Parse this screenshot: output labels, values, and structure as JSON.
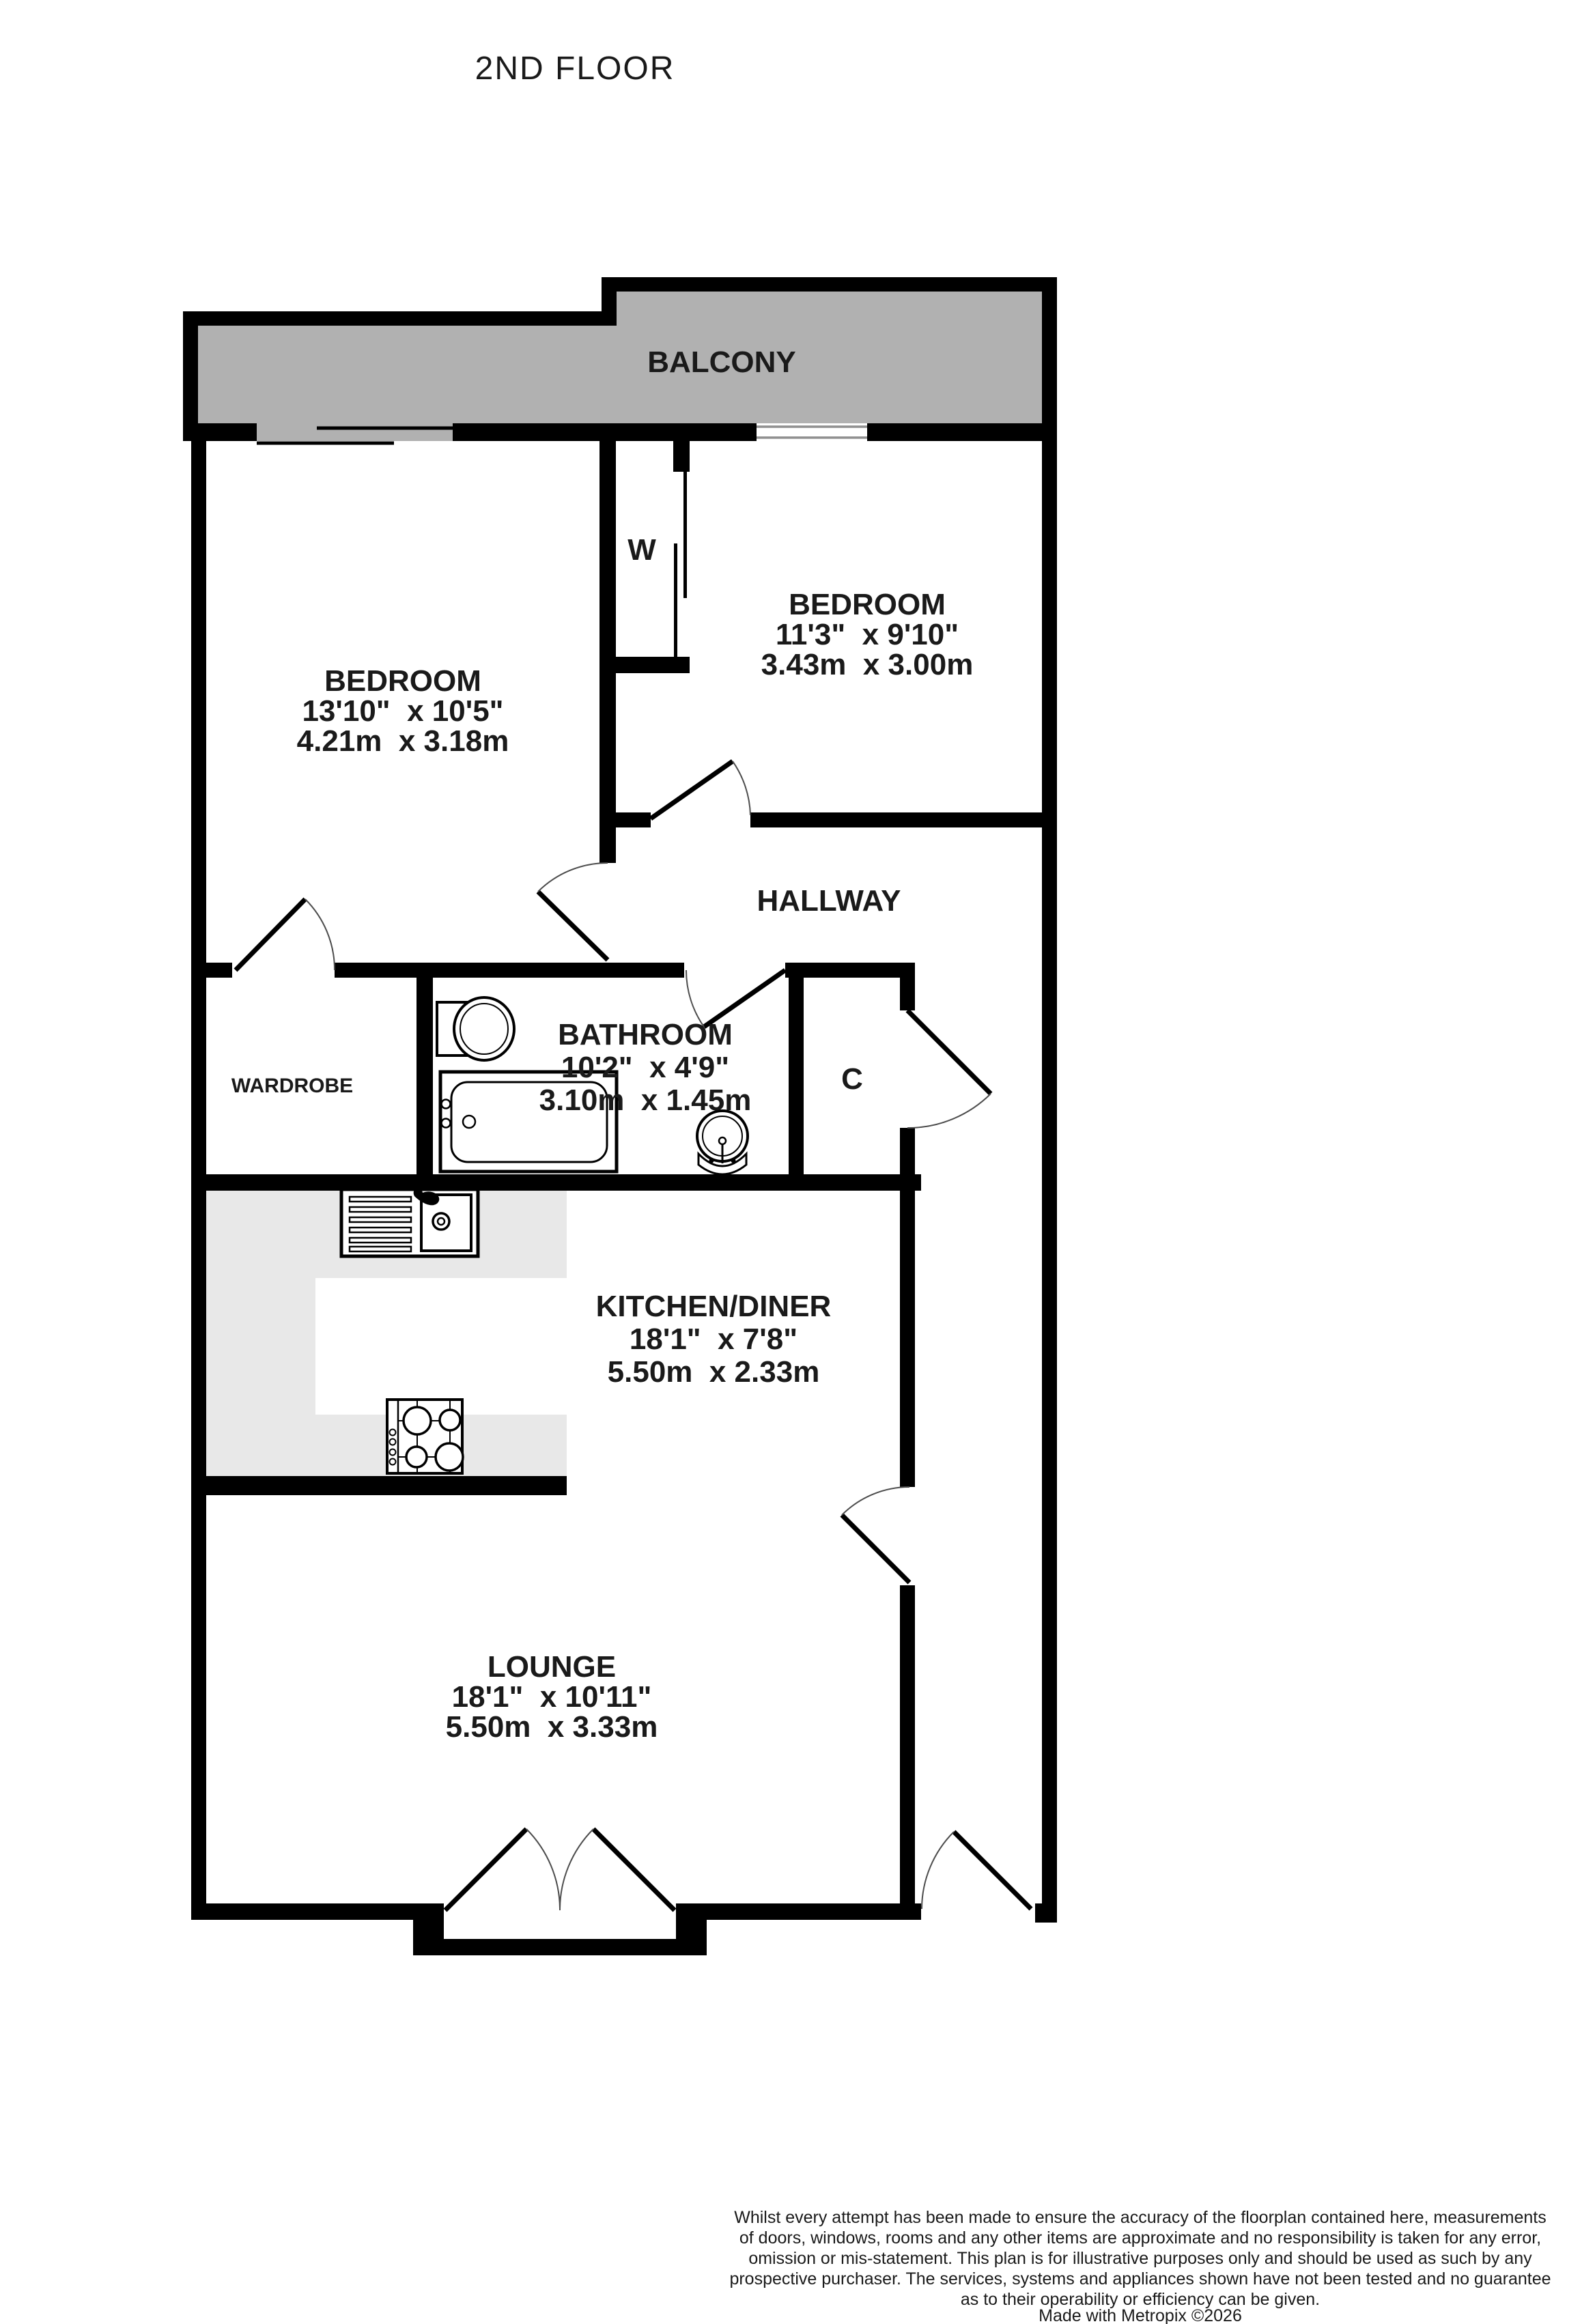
{
  "title": "2ND FLOOR",
  "rooms": {
    "balcony": {
      "label": "BALCONY"
    },
    "bedroom1": {
      "label": "BEDROOM",
      "size_imperial": "13'10\"  x 10'5\"",
      "size_metric": "4.21m  x 3.18m"
    },
    "bedroom2": {
      "label": "BEDROOM",
      "size_imperial": "11'3\"  x 9'10\"",
      "size_metric": "3.43m  x 3.00m"
    },
    "hallway": {
      "label": "HALLWAY"
    },
    "bathroom": {
      "label": "BATHROOM",
      "size_imperial": "10'2\"  x 4'9\"",
      "size_metric": "3.10m  x 1.45m"
    },
    "wardrobe": {
      "label": "WARDROBE"
    },
    "closet": {
      "label": "W"
    },
    "cupboard": {
      "label": "C"
    },
    "kitchen": {
      "label": "KITCHEN/DINER",
      "size_imperial": "18'1\"  x 7'8\"",
      "size_metric": "5.50m  x 2.33m"
    },
    "lounge": {
      "label": "LOUNGE",
      "size_imperial": "18'1\"  x 10'11\"",
      "size_metric": "5.50m  x 3.33m"
    }
  },
  "footer": {
    "lines": [
      "Whilst every attempt has been made to ensure the accuracy of the floorplan contained here, measurements",
      "of doors, windows, rooms and any other items are approximate and no responsibility is taken for any error,",
      "omission or mis-statement. This plan is for illustrative purposes only and should be used as such by any",
      "prospective purchaser. The services, systems and appliances shown have not been tested and no guarantee",
      "as to their operability or efficiency can be given."
    ],
    "credit": "Made with Metropix ©2026"
  },
  "colors": {
    "wall": "#000000",
    "balcony_fill": "#b1b1b1",
    "counter_fill": "#e8e8e8",
    "window_line": "#8f8f8f",
    "door_arc": "#4d4d4d",
    "fixture_outline": "#000000",
    "text": "#1a1a1a"
  }
}
